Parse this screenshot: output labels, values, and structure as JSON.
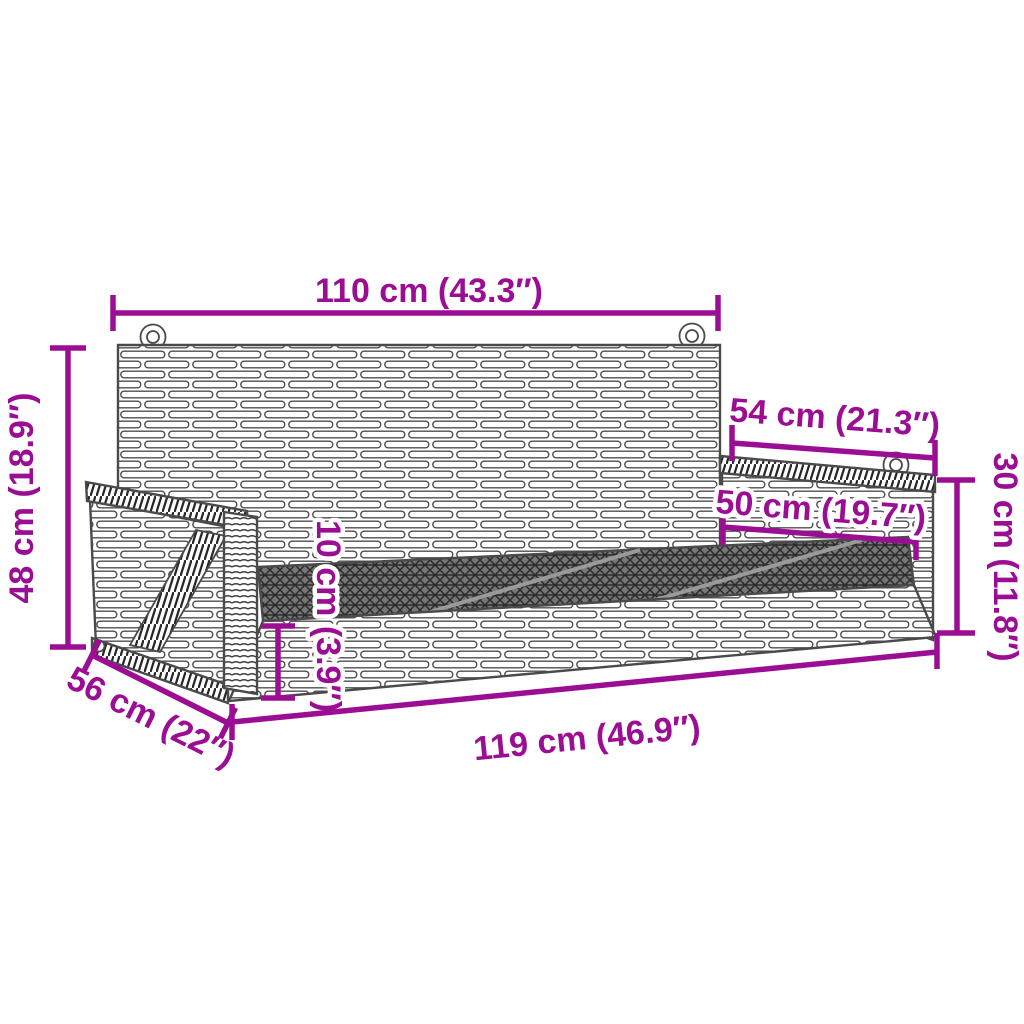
{
  "diagram": {
    "title": "swing-bench-dimension-diagram",
    "colors": {
      "accent": "#9b0e93",
      "line_art": "#4a4a4a",
      "background": "#ffffff"
    },
    "dimensions": {
      "top_width": "110 cm (43.3″)",
      "arm_depth": "54 cm (21.3″)",
      "armrest_length": "50 cm (19.7″)",
      "armrest_height": "30 cm (11.8″)",
      "back_height": "48 cm (18.9″)",
      "seat_thickness": "10 cm (3.9″)",
      "seat_depth": "56 cm (22″)",
      "seat_width": "119 cm (46.9″)"
    }
  }
}
